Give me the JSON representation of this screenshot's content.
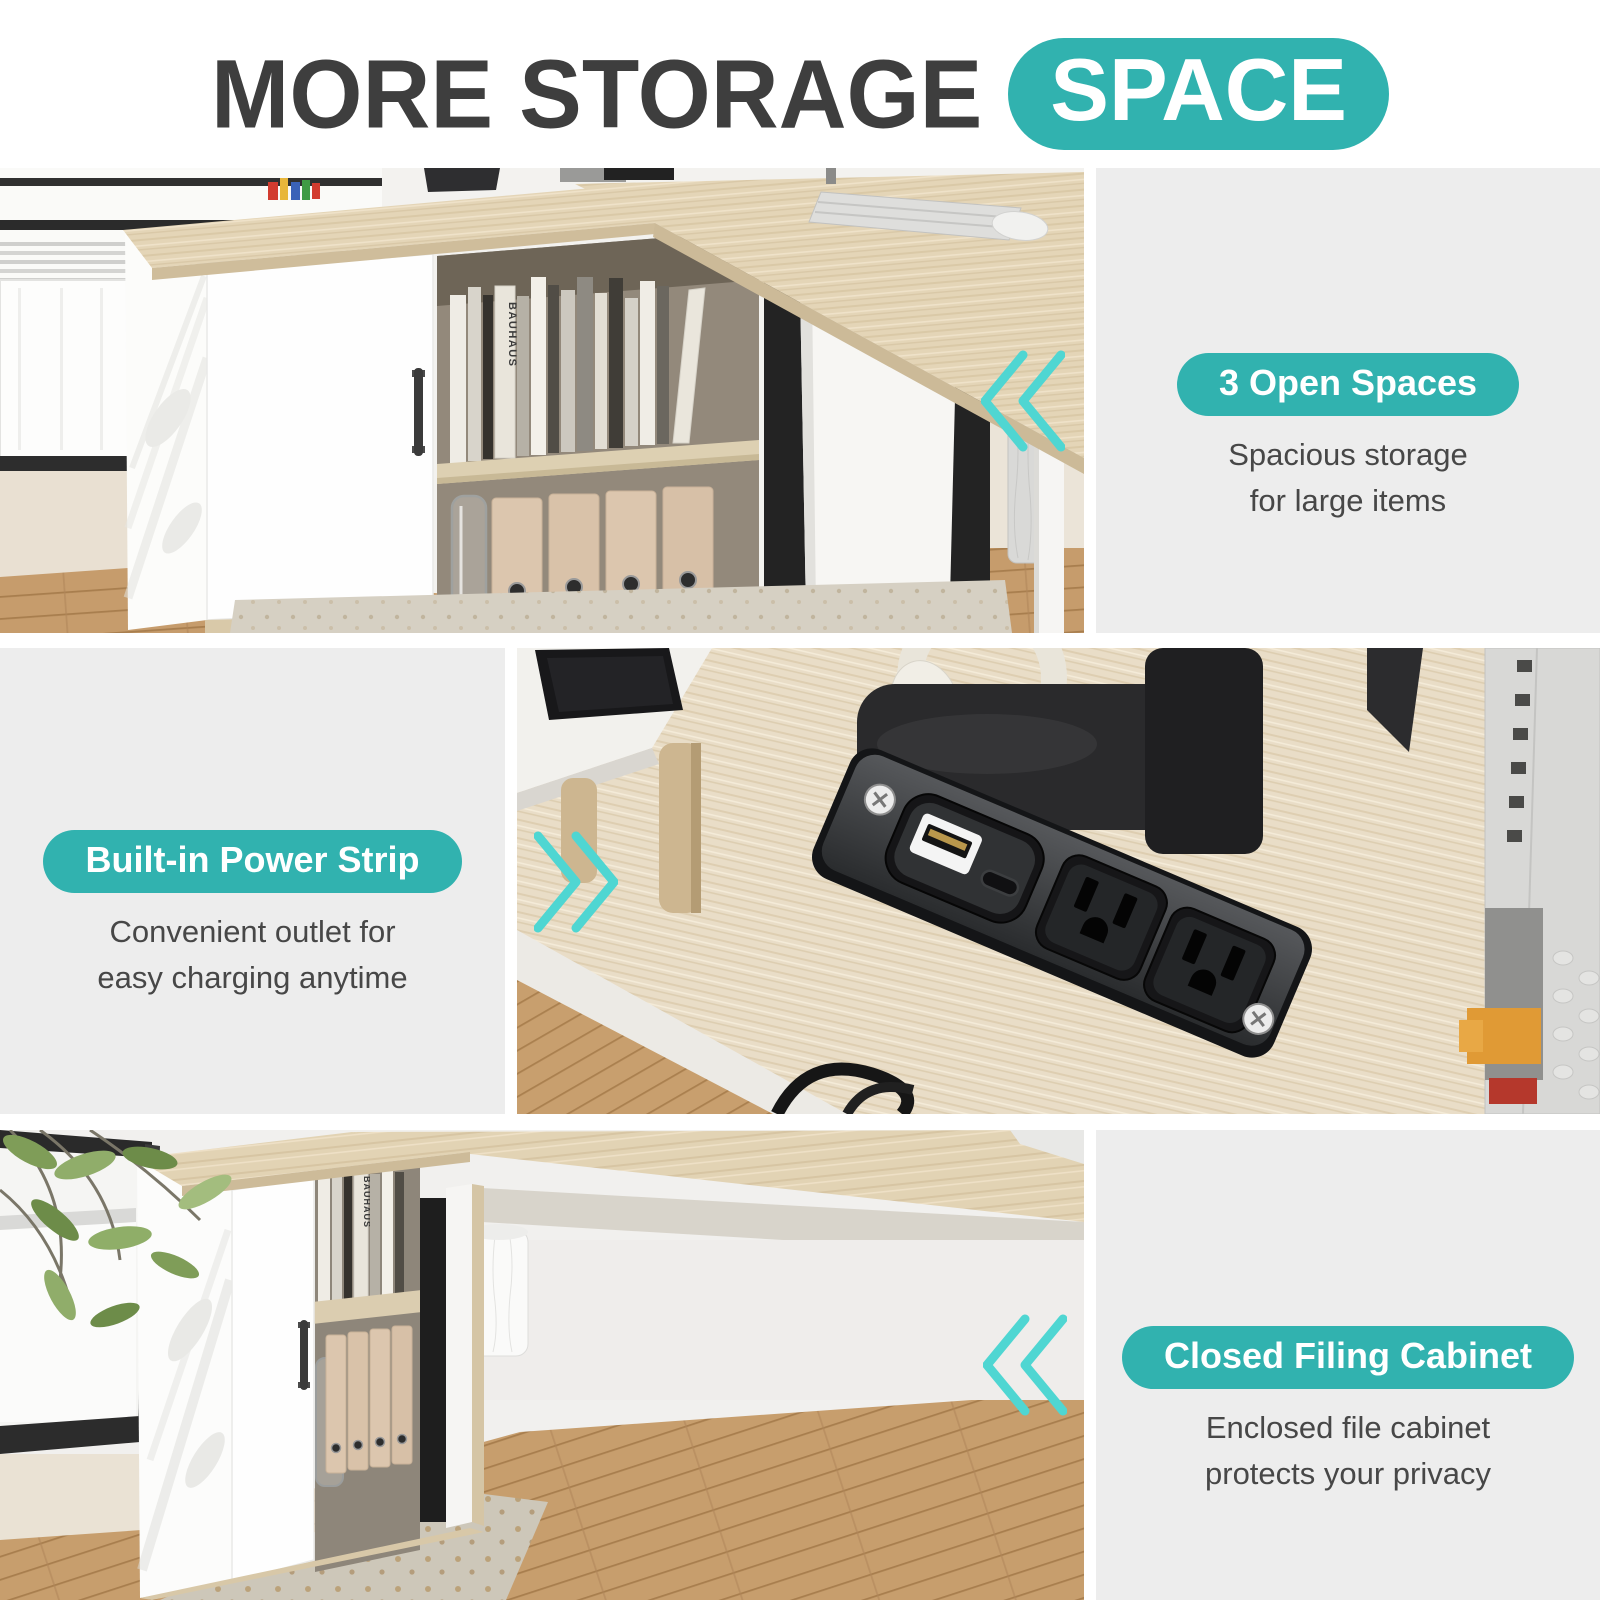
{
  "header": {
    "title": "MORE STORAGE",
    "badge": "SPACE"
  },
  "theme": {
    "teal": "#31B2AF",
    "chevron_teal": "#4FD6D2",
    "title_color": "#3E3E3E",
    "body_text_color": "#474747",
    "panel_bg": "#EDEDED",
    "page_bg": "#FFFFFF"
  },
  "sections": [
    {
      "name": "open-spaces",
      "badge": "3 Open Spaces",
      "desc1": "Spacious storage",
      "desc2": "for large items",
      "arrow_direction": "left"
    },
    {
      "name": "power-strip",
      "badge": "Built-in Power Strip",
      "desc1": "Convenient outlet for",
      "desc2": "easy charging anytime",
      "arrow_direction": "right"
    },
    {
      "name": "filing-cabinet",
      "badge": "Closed Filing Cabinet",
      "desc1": "Enclosed file cabinet",
      "desc2": "protects your privacy",
      "arrow_direction": "left"
    }
  ],
  "photos": {
    "book_spine": "BAUHAUS"
  }
}
